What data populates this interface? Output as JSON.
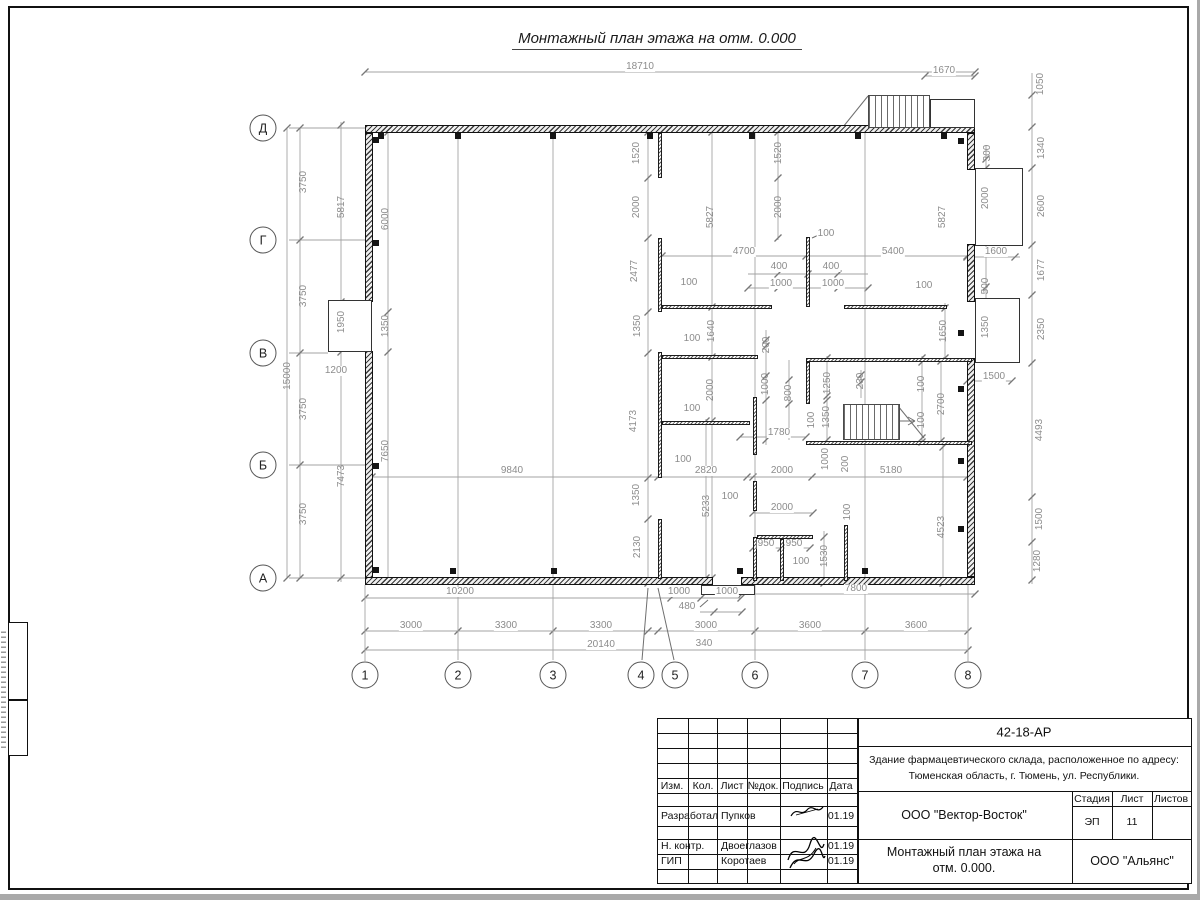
{
  "drawing": {
    "title": "Монтажный план этажа на отм. 0.000",
    "axes": {
      "cols": [
        "1",
        "2",
        "3",
        "4",
        "5",
        "6",
        "7",
        "8"
      ],
      "rows": [
        "Д",
        "Г",
        "В",
        "Б",
        "А"
      ]
    },
    "dim_labels": [
      {
        "t": "18710",
        "x": 640,
        "y": 67
      },
      {
        "t": "1670",
        "x": 944,
        "y": 71
      },
      {
        "t": "1050",
        "x": 1041,
        "y": 84,
        "v": 1
      },
      {
        "t": "1340",
        "x": 1042,
        "y": 148,
        "v": 1
      },
      {
        "t": "2600",
        "x": 1042,
        "y": 206,
        "v": 1
      },
      {
        "t": "1677",
        "x": 1042,
        "y": 270,
        "v": 1
      },
      {
        "t": "2350",
        "x": 1042,
        "y": 329,
        "v": 1
      },
      {
        "t": "4493",
        "x": 1040,
        "y": 430,
        "v": 1
      },
      {
        "t": "1500",
        "x": 1040,
        "y": 519,
        "v": 1
      },
      {
        "t": "1280",
        "x": 1038,
        "y": 561,
        "v": 1
      },
      {
        "t": "300",
        "x": 988,
        "y": 153,
        "v": 1
      },
      {
        "t": "2000",
        "x": 986,
        "y": 198,
        "v": 1
      },
      {
        "t": "1600",
        "x": 996,
        "y": 252
      },
      {
        "t": "500",
        "x": 986,
        "y": 286,
        "v": 1
      },
      {
        "t": "1350",
        "x": 986,
        "y": 327,
        "v": 1
      },
      {
        "t": "1650",
        "x": 944,
        "y": 331,
        "v": 1
      },
      {
        "t": "1500",
        "x": 994,
        "y": 377
      },
      {
        "t": "100",
        "x": 924,
        "y": 286
      },
      {
        "t": "3750",
        "x": 304,
        "y": 182,
        "v": 1
      },
      {
        "t": "3750",
        "x": 304,
        "y": 296,
        "v": 1
      },
      {
        "t": "3750",
        "x": 304,
        "y": 409,
        "v": 1
      },
      {
        "t": "3750",
        "x": 304,
        "y": 514,
        "v": 1
      },
      {
        "t": "15000",
        "x": 288,
        "y": 376,
        "v": 1
      },
      {
        "t": "5817",
        "x": 342,
        "y": 207,
        "v": 1
      },
      {
        "t": "1950",
        "x": 342,
        "y": 322,
        "v": 1
      },
      {
        "t": "7473",
        "x": 342,
        "y": 476,
        "v": 1
      },
      {
        "t": "1200",
        "x": 336,
        "y": 371
      },
      {
        "t": "6000",
        "x": 386,
        "y": 219,
        "v": 1
      },
      {
        "t": "1350",
        "x": 386,
        "y": 326,
        "v": 1
      },
      {
        "t": "7650",
        "x": 386,
        "y": 451,
        "v": 1
      },
      {
        "t": "1520",
        "x": 637,
        "y": 153,
        "v": 1
      },
      {
        "t": "2000",
        "x": 637,
        "y": 207,
        "v": 1
      },
      {
        "t": "2477",
        "x": 635,
        "y": 271,
        "v": 1
      },
      {
        "t": "1350",
        "x": 638,
        "y": 326,
        "v": 1
      },
      {
        "t": "4173",
        "x": 634,
        "y": 421,
        "v": 1
      },
      {
        "t": "1350",
        "x": 637,
        "y": 495,
        "v": 1
      },
      {
        "t": "2130",
        "x": 638,
        "y": 547,
        "v": 1
      },
      {
        "t": "5827",
        "x": 711,
        "y": 217,
        "v": 1
      },
      {
        "t": "1520",
        "x": 779,
        "y": 153,
        "v": 1
      },
      {
        "t": "2000",
        "x": 779,
        "y": 207,
        "v": 1
      },
      {
        "t": "5827",
        "x": 943,
        "y": 217,
        "v": 1
      },
      {
        "t": "4700",
        "x": 744,
        "y": 252
      },
      {
        "t": "5400",
        "x": 893,
        "y": 252
      },
      {
        "t": "100",
        "x": 826,
        "y": 234
      },
      {
        "t": "400",
        "x": 779,
        "y": 267
      },
      {
        "t": "400",
        "x": 831,
        "y": 267
      },
      {
        "t": "1000",
        "x": 781,
        "y": 284
      },
      {
        "t": "1000",
        "x": 833,
        "y": 284
      },
      {
        "t": "100",
        "x": 689,
        "y": 283
      },
      {
        "t": "1640",
        "x": 712,
        "y": 331,
        "v": 1
      },
      {
        "t": "100",
        "x": 692,
        "y": 339
      },
      {
        "t": "200",
        "x": 767,
        "y": 345,
        "v": 1
      },
      {
        "t": "1000",
        "x": 766,
        "y": 384,
        "v": 1
      },
      {
        "t": "800",
        "x": 789,
        "y": 393,
        "v": 1
      },
      {
        "t": "1250",
        "x": 828,
        "y": 383,
        "v": 1
      },
      {
        "t": "230",
        "x": 861,
        "y": 381,
        "v": 1
      },
      {
        "t": "1350",
        "x": 827,
        "y": 417,
        "v": 1
      },
      {
        "t": "100",
        "x": 812,
        "y": 420,
        "v": 1
      },
      {
        "t": "100",
        "x": 922,
        "y": 384,
        "v": 1
      },
      {
        "t": "100",
        "x": 922,
        "y": 420,
        "v": 1
      },
      {
        "t": "2700",
        "x": 942,
        "y": 404,
        "v": 1
      },
      {
        "t": "2000",
        "x": 711,
        "y": 390,
        "v": 1
      },
      {
        "t": "100",
        "x": 692,
        "y": 409
      },
      {
        "t": "1780",
        "x": 779,
        "y": 433
      },
      {
        "t": "1000",
        "x": 826,
        "y": 459,
        "v": 1
      },
      {
        "t": "200",
        "x": 846,
        "y": 464,
        "v": 1
      },
      {
        "t": "9840",
        "x": 512,
        "y": 471
      },
      {
        "t": "2820",
        "x": 706,
        "y": 471
      },
      {
        "t": "2000",
        "x": 782,
        "y": 471
      },
      {
        "t": "5180",
        "x": 891,
        "y": 471
      },
      {
        "t": "100",
        "x": 683,
        "y": 460
      },
      {
        "t": "100",
        "x": 730,
        "y": 497
      },
      {
        "t": "5233",
        "x": 707,
        "y": 506,
        "v": 1
      },
      {
        "t": "2000",
        "x": 782,
        "y": 508
      },
      {
        "t": "100",
        "x": 848,
        "y": 512,
        "v": 1
      },
      {
        "t": "950",
        "x": 766,
        "y": 544
      },
      {
        "t": "950",
        "x": 794,
        "y": 544
      },
      {
        "t": "1530",
        "x": 825,
        "y": 556,
        "v": 1
      },
      {
        "t": "100",
        "x": 801,
        "y": 562
      },
      {
        "t": "4523",
        "x": 942,
        "y": 527,
        "v": 1
      },
      {
        "t": "10200",
        "x": 460,
        "y": 592
      },
      {
        "t": "1000",
        "x": 679,
        "y": 592
      },
      {
        "t": "1000",
        "x": 727,
        "y": 592
      },
      {
        "t": "480",
        "x": 687,
        "y": 607
      },
      {
        "t": "7800",
        "x": 856,
        "y": 589
      },
      {
        "t": "3000",
        "x": 411,
        "y": 626
      },
      {
        "t": "3300",
        "x": 506,
        "y": 626
      },
      {
        "t": "3300",
        "x": 601,
        "y": 626
      },
      {
        "t": "3000",
        "x": 706,
        "y": 626
      },
      {
        "t": "3600",
        "x": 810,
        "y": 626
      },
      {
        "t": "3600",
        "x": 916,
        "y": 626
      },
      {
        "t": "340",
        "x": 704,
        "y": 644
      },
      {
        "t": "20140",
        "x": 601,
        "y": 645
      }
    ]
  },
  "title_block": {
    "doc_number": "42-18-АР",
    "project_line1": "Здание фармацевтического склада, расположенное по адресу:",
    "project_line2": "Тюменская область, г. Тюмень, ул. Республики.",
    "col_izm": "Изм.",
    "col_kol": "Кол.",
    "col_list": "Лист",
    "col_ndok": "№док.",
    "col_podpis": "Подпись",
    "col_data": "Дата",
    "rows": [
      {
        "role": "Разработал",
        "name": "Пупков",
        "date": "01.19"
      },
      {
        "role": "Н. контр.",
        "name": "Двоеглазов",
        "date": "01.19"
      },
      {
        "role": "ГИП",
        "name": "Коротаев",
        "date": "01.19"
      }
    ],
    "org": "ООО \"Вектор-Восток\"",
    "stage_label": "Стадия",
    "sheet_label": "Лист",
    "sheets_label": "Листов",
    "stage": "ЭП",
    "sheet_no": "11",
    "sheets_total": "",
    "plan_title_line1": "Монтажный план этажа на",
    "plan_title_line2": "отм. 0.000.",
    "customer": "ООО \"Альянс\""
  },
  "colors": {
    "wall": "#1a1a1a",
    "dim_gray": "#8c8c8c",
    "paper": "#ffffff"
  }
}
